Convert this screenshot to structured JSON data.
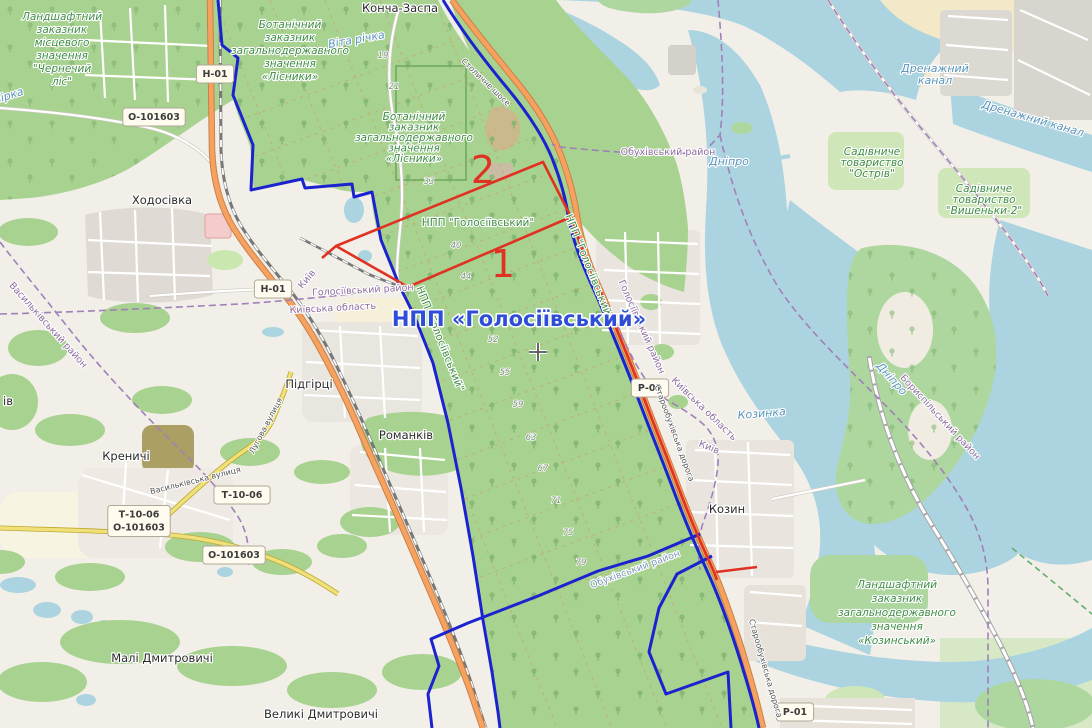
{
  "map": {
    "description": "OpenStreetMap view of Holosiivskyi National Nature Park area south of Kyiv with red and blue overlay boundaries",
    "colors": {
      "land": "#f2efe9",
      "water": "#abd4e0",
      "forest": "#a8d290",
      "overlay_blue": "#1b23cf",
      "overlay_red": "#e03222",
      "admin_purple": "#a080b8",
      "title_blue": "#2f4ed8",
      "reserve_green": "#3f8c46"
    },
    "labels": [
      {
        "n": "town-koncha-zaspa",
        "t": "Конча-Заспа",
        "x": 400,
        "y": 12,
        "c": "town"
      },
      {
        "n": "town-khodosivka",
        "t": "Ходосівка",
        "x": 162,
        "y": 204,
        "c": "town"
      },
      {
        "n": "town-pidhirtsi",
        "t": "Підгірці",
        "x": 309,
        "y": 388,
        "c": "town"
      },
      {
        "n": "town-romankiv",
        "t": "Романків",
        "x": 406,
        "y": 439,
        "c": "town"
      },
      {
        "n": "town-krenychi",
        "t": "Креничі",
        "x": 126,
        "y": 460,
        "c": "town"
      },
      {
        "n": "town-kozyn",
        "t": "Козин",
        "x": 727,
        "y": 513,
        "c": "town",
        "s": 13
      },
      {
        "n": "town-mali-dmytrovychi",
        "t": "Малі Дмитровичі",
        "x": 162,
        "y": 662,
        "c": "town"
      },
      {
        "n": "town-velyki-dmytrovychi",
        "t": "Великі Дмитровичі",
        "x": 321,
        "y": 718,
        "c": "town"
      },
      {
        "n": "town-partial-iv",
        "t": "ів",
        "x": 8,
        "y": 405,
        "c": "town"
      },
      {
        "n": "reserve-chernechyi-lis",
        "lines": [
          "Ландшафтний",
          "заказник",
          "місцевого",
          "значення",
          "\"Чернечий",
          "ліс\""
        ],
        "x": 62,
        "y": 20,
        "lh": 13,
        "c": "reserve"
      },
      {
        "n": "reserve-lisnyky-1",
        "lines": [
          "Ботанічний",
          "заказник",
          "загальнодержавного",
          "значення",
          "«Лісники»"
        ],
        "x": 290,
        "y": 28,
        "lh": 13,
        "c": "reserve"
      },
      {
        "n": "reserve-lisnyky-2",
        "lines": [
          "Ботанічний",
          "заказник",
          "загальнодержавного",
          "значення",
          "«Лісники»"
        ],
        "x": 414,
        "y": 120,
        "lh": 10.5,
        "c": "reserve",
        "s": 8.5
      },
      {
        "n": "reserve-kozynskyi",
        "lines": [
          "Ландшафтний",
          "заказник",
          "загальнодержавного",
          "значення",
          "«Козинський»"
        ],
        "x": 897,
        "y": 588,
        "lh": 14,
        "c": "reserve",
        "s": 11
      },
      {
        "n": "gardens-ostriv",
        "lines": [
          "Садівниче",
          "товариство",
          "\"Острів\""
        ],
        "x": 872,
        "y": 155,
        "lh": 11,
        "c": "reserve",
        "s": 9
      },
      {
        "n": "gardens-vyshenky-2",
        "lines": [
          "Садівниче",
          "товариство",
          "\"Вишеньки-2\""
        ],
        "x": 984,
        "y": 192,
        "lh": 11,
        "c": "reserve",
        "s": 9
      },
      {
        "n": "npp-holosiivskyi-green",
        "t": "НПП \"Голосіївський\"",
        "x": 478,
        "y": 226,
        "c": "npp",
        "s": 11
      },
      {
        "n": "npp-holosiivskyi-road-1",
        "t": "НПП \"Голосіївський\"",
        "x": 586,
        "y": 268,
        "c": "npp",
        "r": 68,
        "s": 9.5
      },
      {
        "n": "npp-holosiivskyi-road-2",
        "t": "НПП \"Голосіївський\"",
        "x": 437,
        "y": 340,
        "c": "npp",
        "r": 68,
        "s": 9.5
      },
      {
        "n": "river-dnipro-1",
        "t": "Дніпро",
        "x": 729,
        "y": 165,
        "c": "water-lbl",
        "s": 12
      },
      {
        "n": "river-dnipro-2",
        "t": "Дніпро",
        "x": 889,
        "y": 381,
        "c": "water-lbl",
        "r": 48
      },
      {
        "n": "river-vita",
        "t": "Віта річка",
        "x": 357,
        "y": 43,
        "c": "water-lbl",
        "r": -10,
        "s": 9
      },
      {
        "n": "river-kozynka",
        "t": "Козинка",
        "x": 762,
        "y": 417,
        "c": "water-lbl",
        "r": -5,
        "s": 9.5
      },
      {
        "n": "drainage-canal-1",
        "lines": [
          "Дренажний",
          "канал"
        ],
        "x": 935,
        "y": 72,
        "lh": 12,
        "c": "water-lbl",
        "s": 10
      },
      {
        "n": "drainage-canal-2",
        "t": "Дренажний канал",
        "x": 1032,
        "y": 122,
        "c": "water-lbl",
        "r": 16,
        "s": 10
      },
      {
        "n": "river-partial",
        "t": "вірка",
        "x": 10,
        "y": 99,
        "c": "water-lbl",
        "r": -18,
        "s": 8.5
      },
      {
        "n": "admin-obukhivskyi-1",
        "t": "Обухівський район",
        "x": 668,
        "y": 155,
        "c": "admin"
      },
      {
        "n": "admin-holosiivskyi-1",
        "t": "Голосіївський район",
        "x": 363,
        "y": 293,
        "c": "admin",
        "r": -3
      },
      {
        "n": "admin-kyivska-oblast-1",
        "t": "Київська область",
        "x": 333,
        "y": 311,
        "c": "admin",
        "r": -3
      },
      {
        "n": "admin-kyiv-1",
        "t": "Київ",
        "x": 309,
        "y": 281,
        "c": "admin",
        "r": -50,
        "s": 9
      },
      {
        "n": "admin-holosiivskyi-2",
        "t": "Голосіївський район",
        "x": 639,
        "y": 328,
        "c": "admin",
        "r": 66
      },
      {
        "n": "admin-kyivska-oblast-2",
        "t": "Київська область",
        "x": 702,
        "y": 411,
        "c": "admin",
        "r": 44
      },
      {
        "n": "admin-kyiv-2",
        "t": "Київ",
        "x": 708,
        "y": 450,
        "c": "admin",
        "r": 22,
        "s": 9
      },
      {
        "n": "admin-vasylkivskyi",
        "t": "Васильківський район",
        "x": 46,
        "y": 327,
        "c": "admin",
        "r": 48
      },
      {
        "n": "admin-boryspilskyi",
        "t": "Бориспільський район",
        "x": 938,
        "y": 419,
        "c": "admin",
        "r": 47
      },
      {
        "n": "admin-obukhivskyi-2",
        "t": "Обухівський район",
        "x": 636,
        "y": 572,
        "c": "admin2",
        "r": -20
      },
      {
        "n": "street-vasylkivska",
        "t": "Васильківська вулиця",
        "x": 196,
        "y": 483,
        "c": "street",
        "r": -14
      },
      {
        "n": "street-luhova",
        "t": "Лугова вулиця",
        "x": 268,
        "y": 427,
        "c": "street",
        "r": -62
      },
      {
        "n": "street-stolychne-shose",
        "t": "Столичне шосе",
        "x": 484,
        "y": 84,
        "c": "street",
        "r": 44
      },
      {
        "n": "street-staroobukhivska-1",
        "t": "Старообухівська дорога",
        "x": 672,
        "y": 434,
        "c": "street",
        "r": 70
      },
      {
        "n": "street-staroobukhivska-2",
        "t": "Старообухівська дорога",
        "x": 763,
        "y": 669,
        "c": "street",
        "r": 74
      },
      {
        "n": "qnum-19",
        "t": "19",
        "x": 383,
        "y": 58,
        "c": "qnum"
      },
      {
        "n": "qnum-21",
        "t": "21",
        "x": 394,
        "y": 89,
        "c": "qnum"
      },
      {
        "n": "qnum-33",
        "t": "33",
        "x": 429,
        "y": 184,
        "c": "qnum"
      },
      {
        "n": "qnum-40",
        "t": "40",
        "x": 456,
        "y": 248,
        "c": "qnum"
      },
      {
        "n": "qnum-44",
        "t": "44",
        "x": 466,
        "y": 279,
        "c": "qnum"
      },
      {
        "n": "qnum-52",
        "t": "52",
        "x": 493,
        "y": 342,
        "c": "qnum"
      },
      {
        "n": "qnum-55",
        "t": "55",
        "x": 505,
        "y": 375,
        "c": "qnum"
      },
      {
        "n": "qnum-59",
        "t": "59",
        "x": 518,
        "y": 407,
        "c": "qnum"
      },
      {
        "n": "qnum-63",
        "t": "63",
        "x": 531,
        "y": 440,
        "c": "qnum"
      },
      {
        "n": "qnum-67",
        "t": "67",
        "x": 543,
        "y": 471,
        "c": "qnum"
      },
      {
        "n": "qnum-71",
        "t": "71",
        "x": 556,
        "y": 503,
        "c": "qnum"
      },
      {
        "n": "qnum-75",
        "t": "75",
        "x": 568,
        "y": 535,
        "c": "qnum"
      },
      {
        "n": "qnum-79",
        "t": "79",
        "x": 581,
        "y": 565,
        "c": "qnum"
      },
      {
        "n": "zone-2-number",
        "t": "2",
        "x": 483,
        "y": 183,
        "c": "red-num"
      },
      {
        "n": "zone-1-number",
        "t": "1",
        "x": 503,
        "y": 277,
        "c": "red-num"
      },
      {
        "n": "npp-holosiivskyi-title",
        "t": "НПП «Голосіївський»",
        "x": 519,
        "y": 326,
        "c": "title"
      }
    ],
    "shields": [
      {
        "n": "road-shield-h01-top",
        "lines": [
          "Н-01"
        ],
        "x": 215,
        "y": 74
      },
      {
        "n": "road-shield-o101603-top",
        "lines": [
          "О-101603"
        ],
        "x": 154,
        "y": 117
      },
      {
        "n": "road-shield-h01-mid",
        "lines": [
          "Н-01"
        ],
        "x": 273,
        "y": 289
      },
      {
        "n": "road-shield-p01-mid",
        "lines": [
          "Р-01"
        ],
        "x": 650,
        "y": 388
      },
      {
        "n": "road-shield-p01-bottom",
        "lines": [
          "Р-01"
        ],
        "x": 795,
        "y": 712
      },
      {
        "n": "road-shield-t1006",
        "lines": [
          "Т-10-06"
        ],
        "x": 242,
        "y": 495
      },
      {
        "n": "road-shield-t1006-o101603",
        "lines": [
          "Т-10-06",
          "О-101603"
        ],
        "x": 139,
        "y": 521
      },
      {
        "n": "road-shield-o101603-bottom",
        "lines": [
          "О-101603"
        ],
        "x": 234,
        "y": 555
      }
    ]
  }
}
